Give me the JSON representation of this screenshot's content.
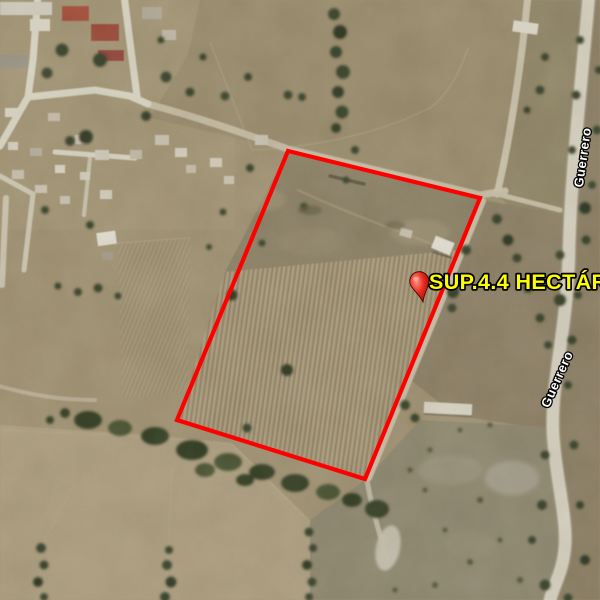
{
  "window": {
    "width": 600,
    "height": 600
  },
  "map": {
    "kind": "satellite-imagery",
    "parcel": {
      "area_label": "SUP.4.4 HECTÁREAS",
      "area_label_color": "#ffff00",
      "boundary_color": "#ff0000",
      "boundary_points": "288,151 480,198 365,479 177,420",
      "pin_transform": "translate(423,302) rotate(-10)",
      "pin_color": "#e03127"
    },
    "street_labels": [
      {
        "name": "Guerrero",
        "color": "#ffffff"
      },
      {
        "name": "Guerrero",
        "color": "#ffffff"
      }
    ]
  }
}
